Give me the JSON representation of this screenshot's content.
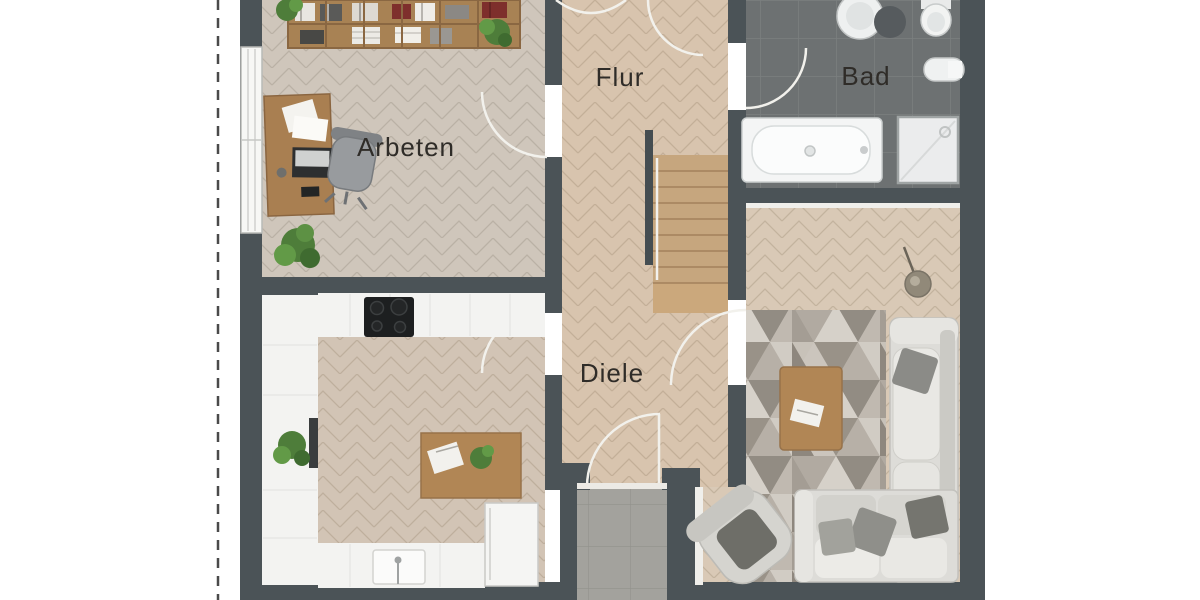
{
  "floor_plan": {
    "labels": {
      "office": "Arbeten",
      "upper_hallway": "Flur",
      "bathroom": "Bad",
      "lower_hallway": "Diele"
    },
    "colors": {
      "background": "#ffffff",
      "wall": "#4b5357",
      "office_floor": "#cfc6bb",
      "hallway_floor": "#d8c4ae",
      "living_floor": "#d9c9b6",
      "kitchen_floor": "#d2c4b5",
      "bathroom_tile": "#6d7172",
      "entrance_tile": "#a3a29d",
      "counter_white": "#f3f3f1",
      "wood_furniture": "#b18655",
      "stairs_wood": "#c6a67e",
      "sofa_gray": "#dddcd8",
      "rug_base": "#c8c2b9",
      "plant_green": "#4e7d3a",
      "label_text": "#2f2c28"
    }
  }
}
